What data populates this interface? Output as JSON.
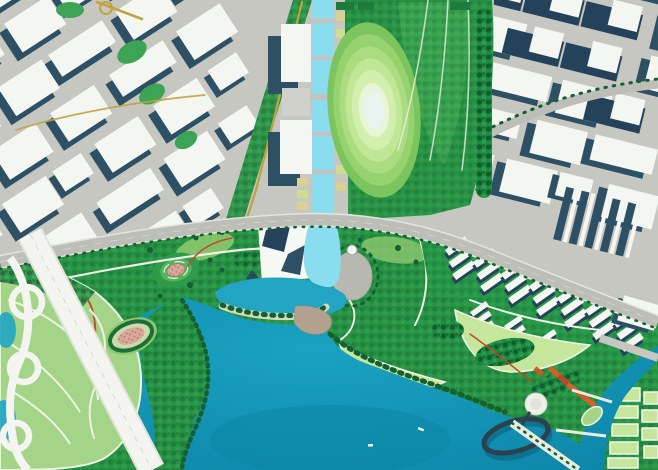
{
  "meta": {
    "description": "Aerial masterplan rendering of a coastal urban district: white city blocks with slate shadows, a central light-blue canal ending at a landmark building, an oval concentric great lawn, a large waterfront park, a teal bay with a leaf-shaped island, an elevated white highway, an elliptical ring pier and terraced residential rows.",
    "visible_text": "none"
  },
  "palette": {
    "roadGray": "#c6c7c1",
    "roadDark": "#bdbeb7",
    "blockWhite": "#f4f6f2",
    "shadowSlate": "#2e5065",
    "shadowDeep": "#24435a",
    "canalBlue": "#8adcef",
    "bayTeal": "#1598b9",
    "bayDeep": "#0d86a8",
    "lakeTeal": "#21a5c2",
    "parkMid": "#2f9e4a",
    "parkDark": "#1d7c3b",
    "treeDark": "#14602f",
    "lawnLight": "#a6d77f",
    "lawnPale": "#c6e79b",
    "ovalCore": "#e9f3ef",
    "islandGreen": "#a3d487",
    "veinWhite": "#edf5e3",
    "highwayWhite": "#f4f5f0",
    "yellowRoad": "#c2a23c",
    "redPath": "#c2472e",
    "pinkFill": "#d8a89c",
    "orangeRoof": "#d2622c",
    "plazaGray": "#b7b8b0",
    "beachTan": "#b3a08e",
    "pierDark": "#2b414d",
    "ringShadow": "#0a6c8b",
    "tanBlock": "#d9d094"
  },
  "features": [
    {
      "id": "city-blocks-west",
      "label": "Northwest city blocks"
    },
    {
      "id": "city-blocks-east",
      "label": "Northeast city blocks"
    },
    {
      "id": "central-canal",
      "label": "Central canal"
    },
    {
      "id": "oval-lawn-park",
      "label": "Oval great lawn park"
    },
    {
      "id": "waterfront-park",
      "label": "Waterfront park"
    },
    {
      "id": "bay",
      "label": "Bay"
    },
    {
      "id": "leaf-island",
      "label": "Leaf-shaped island"
    },
    {
      "id": "elevated-highway",
      "label": "Elevated highway"
    },
    {
      "id": "canal-landmark",
      "label": "Canal-end landmark building"
    },
    {
      "id": "harbor-lake",
      "label": "Harbor lake"
    },
    {
      "id": "oval-plaza",
      "label": "Oval plaza"
    },
    {
      "id": "spiral-mound",
      "label": "Spiral mound garden"
    },
    {
      "id": "event-oval",
      "label": "Oval event lawn"
    },
    {
      "id": "beach-cove",
      "label": "Beach cove"
    },
    {
      "id": "residential-terraces",
      "label": "Terraced residential rows"
    },
    {
      "id": "ring-pier",
      "label": "Elliptical ring pier"
    },
    {
      "id": "boardwalk-pier",
      "label": "Boardwalk pier"
    },
    {
      "id": "southeast-canal",
      "label": "Southeast canal"
    },
    {
      "id": "lawn-grid",
      "label": "Lawn grid blocks"
    },
    {
      "id": "waterfront-boulevard",
      "label": "Waterfront boulevard"
    }
  ]
}
